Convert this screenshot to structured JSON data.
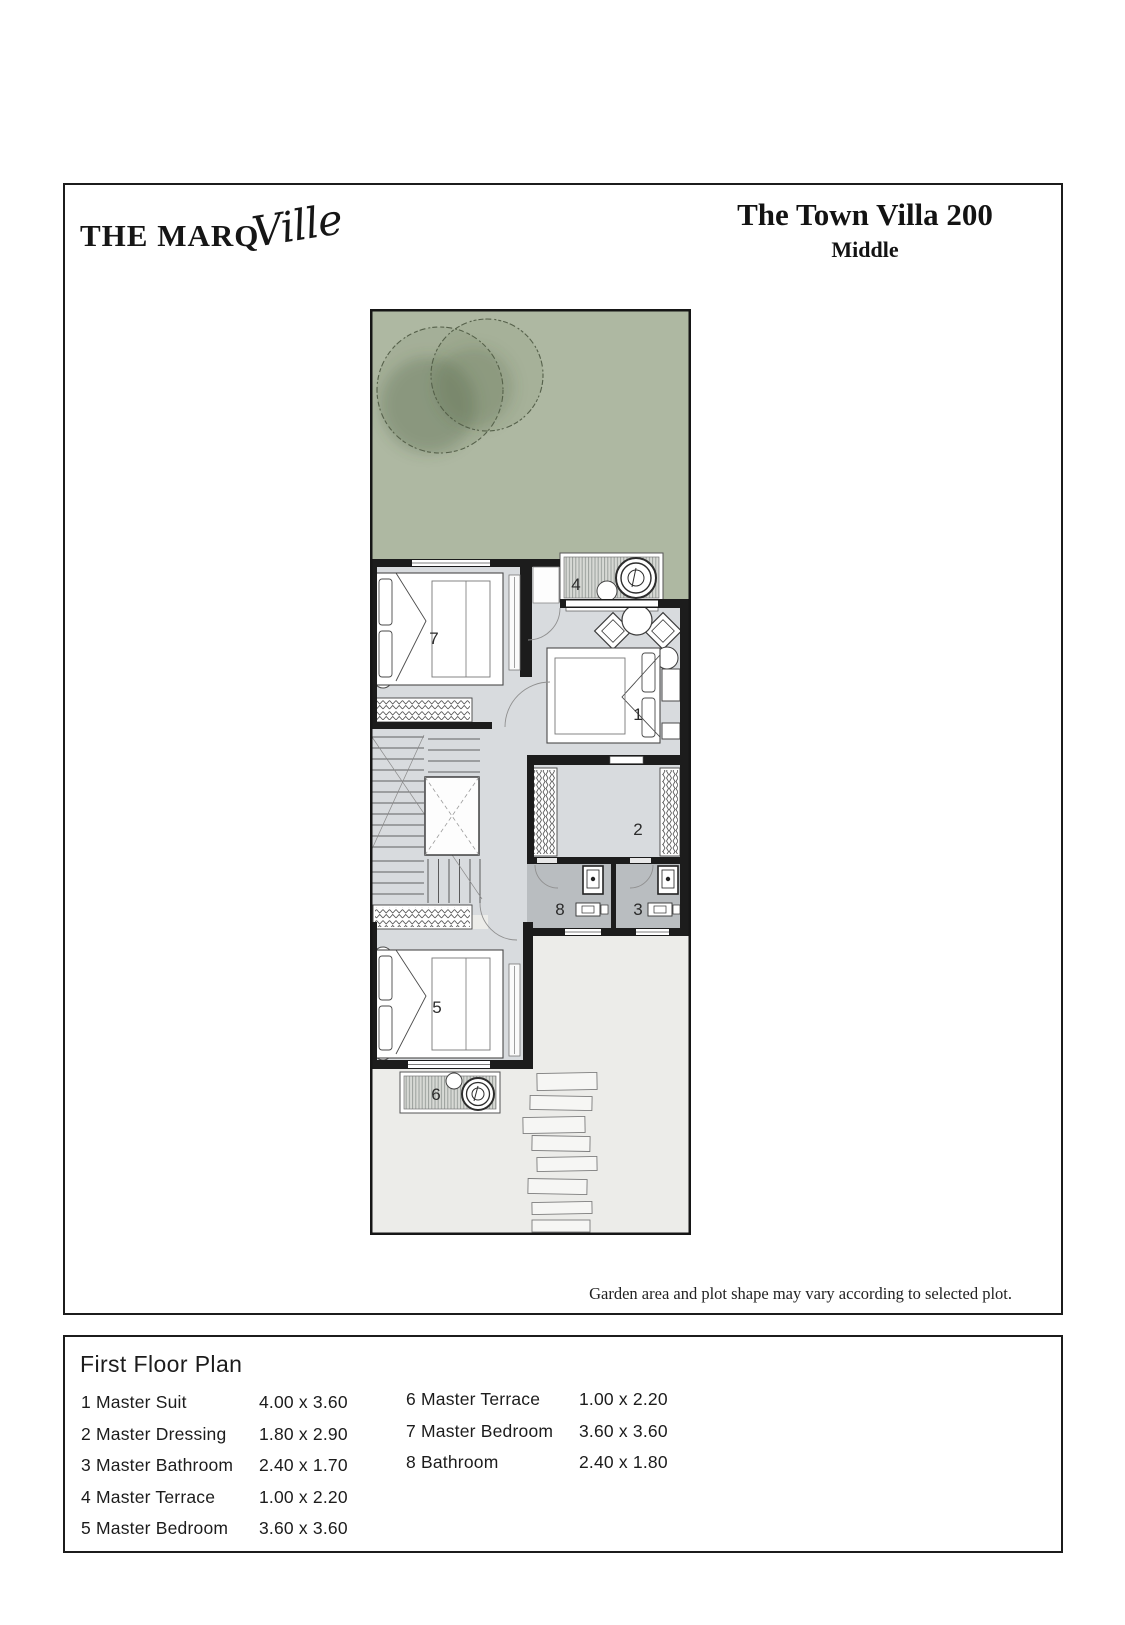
{
  "header": {
    "brand": "THE MARQ",
    "brand_script": "Ville",
    "title": "The Town Villa 200",
    "subtitle": "Middle"
  },
  "plan": {
    "disclaimer": "Garden area and plot shape may vary according to selected plot.",
    "rooms": {
      "r1": "1",
      "r2": "2",
      "r3": "3",
      "r4": "4",
      "r5": "5",
      "r6": "6",
      "r7": "7",
      "r8": "8"
    }
  },
  "legend": {
    "title": "First Floor Plan",
    "col1": [
      {
        "num": "1",
        "label": "Master Suit",
        "dims": "4.00 x 3.60"
      },
      {
        "num": "2",
        "label": "Master Dressing",
        "dims": "1.80 x 2.90"
      },
      {
        "num": "3",
        "label": "Master Bathroom",
        "dims": "2.40 x 1.70"
      },
      {
        "num": "4",
        "label": "Master Terrace",
        "dims": "1.00 x 2.20"
      },
      {
        "num": "5",
        "label": "Master Bedroom",
        "dims": "3.60 x 3.60"
      }
    ],
    "col2": [
      {
        "num": "6",
        "label": "Master Terrace",
        "dims": "1.00 x  2.20"
      },
      {
        "num": "7",
        "label": "Master Bedroom",
        "dims": "3.60 x  3.60"
      },
      {
        "num": "8",
        "label": "Bathroom",
        "dims": "2.40 x  1.80"
      }
    ]
  },
  "colors": {
    "garden_green": "#aeb8a2",
    "floor_gray": "#d8dbde",
    "bath_gray": "#b9bdc0",
    "patio": "#ecece9",
    "wall": "#1c1c1c"
  }
}
